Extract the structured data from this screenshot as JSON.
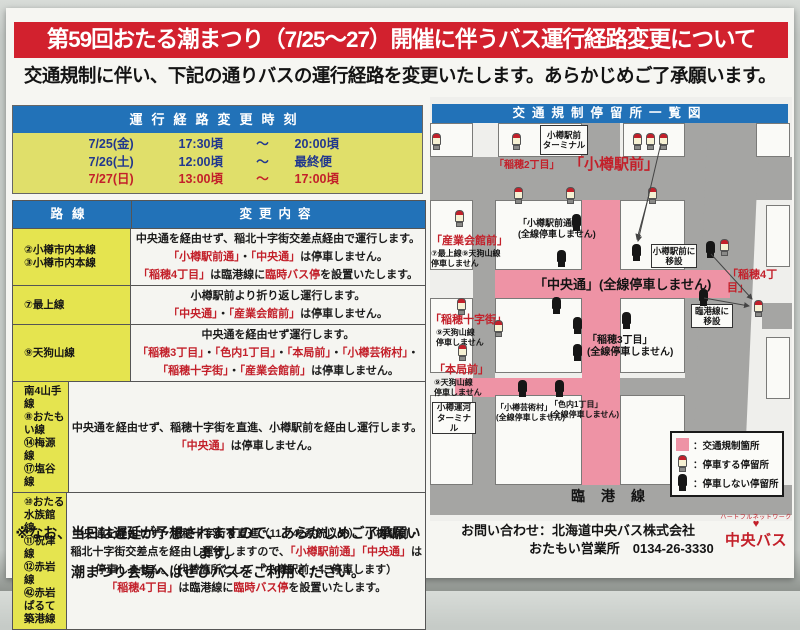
{
  "colors": {
    "banner": "#d2212e",
    "blue": "#2272b8",
    "yellow": "#e0df6a",
    "yellow2": "#e5e44f",
    "red": "#c3202a",
    "navy": "#22388e",
    "pink": "#ee93a5",
    "road": "#a5a5a3"
  },
  "title": "第59回おたる潮まつり（7/25～27）開催に伴うバス運行経路変更について",
  "subtitle": "交通規制に伴い、下記の通りバスの運行経路を変更いたします。あらかじめご了承願います。",
  "schedule": {
    "header": "運行経路変更時刻",
    "rows": [
      {
        "d": "7/25(金)",
        "s": "17:30頃",
        "t": "～",
        "e": "20:00頃",
        "red": false
      },
      {
        "d": "7/26(土)",
        "s": "12:00頃",
        "t": "～",
        "e": "最終便",
        "red": false
      },
      {
        "d": "7/27(日)",
        "s": "13:00頃",
        "t": "～",
        "e": "17:00頃",
        "red": true
      }
    ]
  },
  "route_table": {
    "col_route": "路線",
    "col_change": "変更内容",
    "rows": [
      {
        "routes": [
          "②小樽市内本線",
          "③小樽市内本線"
        ],
        "lines": [
          [
            {
              "t": "中央通を経由せず、稲北十字街交差点経由で運行します。",
              "c": "k"
            }
          ],
          [
            {
              "t": "「小樽駅前通」",
              "c": "r"
            },
            {
              "t": "・",
              "c": "k"
            },
            {
              "t": "「中央通」",
              "c": "r"
            },
            {
              "t": "は停車しません。",
              "c": "k"
            }
          ],
          [
            {
              "t": "「稲穂4丁目」",
              "c": "r"
            },
            {
              "t": "は臨港線に",
              "c": "k"
            },
            {
              "t": "臨時バス停",
              "c": "r"
            },
            {
              "t": "を設置いたします。",
              "c": "k"
            }
          ]
        ]
      },
      {
        "routes": [
          "⑦最上線"
        ],
        "lines": [
          [
            {
              "t": "小樽駅前より折り返し運行します。",
              "c": "k"
            }
          ],
          [
            {
              "t": "「中央通」",
              "c": "r"
            },
            {
              "t": "・",
              "c": "k"
            },
            {
              "t": "「産業会館前」",
              "c": "r"
            },
            {
              "t": "は停車しません。",
              "c": "k"
            }
          ]
        ]
      },
      {
        "routes": [
          "⑨天狗山線"
        ],
        "lines": [
          [
            {
              "t": "中央通を経由せず運行します。",
              "c": "k"
            }
          ],
          [
            {
              "t": "「稲穂3丁目」",
              "c": "r"
            },
            {
              "t": "・",
              "c": "k"
            },
            {
              "t": "「色内1丁目」",
              "c": "r"
            },
            {
              "t": "・",
              "c": "k"
            },
            {
              "t": "「本局前」",
              "c": "r"
            },
            {
              "t": "・",
              "c": "k"
            },
            {
              "t": "「小樽芸術村」",
              "c": "r"
            },
            {
              "t": "・",
              "c": "k"
            }
          ],
          [
            {
              "t": "「稲穂十字街」",
              "c": "r"
            },
            {
              "t": "・",
              "c": "k"
            },
            {
              "t": "「産業会館前」",
              "c": "r"
            },
            {
              "t": "は停車しません。",
              "c": "k"
            }
          ]
        ]
      },
      {
        "routes": [
          "南4山手線",
          "⑧おたもい線",
          "⑭梅源線",
          "⑰塩谷線"
        ],
        "lines": [
          [
            {
              "t": "中央通を経由せず、稲穂十字街を直進、小樽駅前を経由し運行します。",
              "c": "k"
            }
          ],
          [
            {
              "t": "「中央通」",
              "c": "r"
            },
            {
              "t": "は停車しません。",
              "c": "k"
            }
          ]
        ]
      },
      {
        "routes": [
          "⑩おたる水族館線",
          "⑪祝津線",
          "⑫赤岩線",
          "㊷赤岩ぱるて築港線"
        ],
        "lines": [
          [
            {
              "t": "中央通を経由せず、稲穂十字街を直進（11、42系統以外）、小樽駅前・",
              "c": "k"
            }
          ],
          [
            {
              "t": "稲北十字街交差点を経由し運行しますので、",
              "c": "k"
            },
            {
              "t": "「小樽駅前通」「中央通」",
              "c": "r"
            },
            {
              "t": "は",
              "c": "k"
            }
          ],
          [
            {
              "t": "停車しません。（代替箇所として「小樽駅前」に停車します）",
              "c": "k"
            }
          ],
          [
            {
              "t": "「稲穂4丁目」",
              "c": "r"
            },
            {
              "t": "は臨港線に",
              "c": "k"
            },
            {
              "t": "臨時バス停",
              "c": "r"
            },
            {
              "t": "を設置いたします。",
              "c": "k"
            }
          ]
        ]
      }
    ]
  },
  "note": {
    "l1": "※なお、当日は遅延が予想されますので、あらかじめご了承願います。",
    "l2": "潮まつり会場へはぜひバスをご利用ください。"
  },
  "contact": {
    "l1": "お問い合わせ：北海道中央バス株式会社",
    "l2": "おたもい営業所　0134-26-3330"
  },
  "logo": {
    "arc": "ハートフルネットワーク",
    "heart": "♥",
    "name": "中央バス"
  },
  "map": {
    "title": "交通規制停留所一覧図",
    "rinko_label": "臨港線",
    "labels": [
      {
        "text": "「稲穂2丁目」",
        "x": 64,
        "y": 63,
        "cls": "red s10"
      },
      {
        "text": "「小樽駅前」",
        "x": 139,
        "y": 59,
        "cls": "red s15"
      },
      {
        "text": "「小樽駅前通」\n(全線停車しません)",
        "x": 88,
        "y": 121,
        "cls": "blk s9"
      },
      {
        "text": "「産業会館前」",
        "x": 1,
        "y": 138,
        "cls": "red s11"
      },
      {
        "text": "⑦最上線⑨天狗山線\n停車しません",
        "x": 1,
        "y": 152,
        "cls": "blk s8"
      },
      {
        "text": "「中央通」(全線停車しません)",
        "x": 104,
        "y": 180,
        "cls": "blk s13"
      },
      {
        "text": "「稲穂4丁目」",
        "x": 297,
        "y": 172,
        "cls": "red s11"
      },
      {
        "text": "「稲穂十字街」",
        "x": 0,
        "y": 217,
        "cls": "red s11"
      },
      {
        "text": "⑨天狗山線\n停車しません",
        "x": 6,
        "y": 231,
        "cls": "blk s8"
      },
      {
        "text": "「稲穂3丁目」\n(全線停車しません)",
        "x": 157,
        "y": 238,
        "cls": "blk s10"
      },
      {
        "text": "「本局前」",
        "x": 4,
        "y": 267,
        "cls": "red s11"
      },
      {
        "text": "⑨天狗山線\n停車しません",
        "x": 4,
        "y": 281,
        "cls": "blk s8"
      },
      {
        "text": "「小樽芸術村」\n(全線停車しません)",
        "x": 66,
        "y": 306,
        "cls": "blk s8"
      },
      {
        "text": "「色内1丁目」\n(全線停車しません)",
        "x": 120,
        "y": 303,
        "cls": "blk s8"
      }
    ],
    "boxes": [
      {
        "text": "小樽駅前\nターミナル",
        "x": 110,
        "y": 28,
        "w": 48,
        "h": 30
      },
      {
        "text": "小樽駅前に\n移設",
        "x": 221,
        "y": 147,
        "w": 46,
        "h": 24
      },
      {
        "text": "臨港線に\n移設",
        "x": 261,
        "y": 207,
        "w": 42,
        "h": 24
      },
      {
        "text": "小樽運河\nターミナル",
        "x": 2,
        "y": 305,
        "w": 44,
        "h": 32
      }
    ],
    "stops": [
      {
        "t": "r",
        "x": 2,
        "y": 36
      },
      {
        "t": "r",
        "x": 82,
        "y": 36
      },
      {
        "t": "r",
        "x": 203,
        "y": 36
      },
      {
        "t": "r",
        "x": 216,
        "y": 36
      },
      {
        "t": "r",
        "x": 229,
        "y": 36
      },
      {
        "t": "r",
        "x": 84,
        "y": 90
      },
      {
        "t": "r",
        "x": 136,
        "y": 90
      },
      {
        "t": "r",
        "x": 218,
        "y": 90
      },
      {
        "t": "r",
        "x": 25,
        "y": 113
      },
      {
        "t": "r",
        "x": 27,
        "y": 201
      },
      {
        "t": "r",
        "x": 28,
        "y": 247
      },
      {
        "t": "r",
        "x": 64,
        "y": 223
      },
      {
        "t": "r",
        "x": 290,
        "y": 142
      },
      {
        "t": "r",
        "x": 324,
        "y": 203
      },
      {
        "t": "b",
        "x": 142,
        "y": 117
      },
      {
        "t": "b",
        "x": 127,
        "y": 153
      },
      {
        "t": "b",
        "x": 202,
        "y": 147
      },
      {
        "t": "b",
        "x": 276,
        "y": 144
      },
      {
        "t": "b",
        "x": 122,
        "y": 200
      },
      {
        "t": "b",
        "x": 143,
        "y": 220
      },
      {
        "t": "b",
        "x": 143,
        "y": 247
      },
      {
        "t": "b",
        "x": 192,
        "y": 215
      },
      {
        "t": "b",
        "x": 269,
        "y": 192
      },
      {
        "t": "b",
        "x": 88,
        "y": 283
      },
      {
        "t": "b",
        "x": 125,
        "y": 283
      }
    ],
    "arrows": [
      [
        231,
        46,
        208,
        144
      ],
      [
        219,
        98,
        207,
        142
      ],
      [
        281,
        157,
        322,
        202
      ],
      [
        274,
        201,
        319,
        209
      ]
    ],
    "legend": [
      {
        "type": "pink",
        "label": "：交通規制箇所"
      },
      {
        "type": "rstop",
        "label": "：停車する停留所"
      },
      {
        "type": "bstop",
        "label": "：停車しない停留所"
      }
    ]
  }
}
